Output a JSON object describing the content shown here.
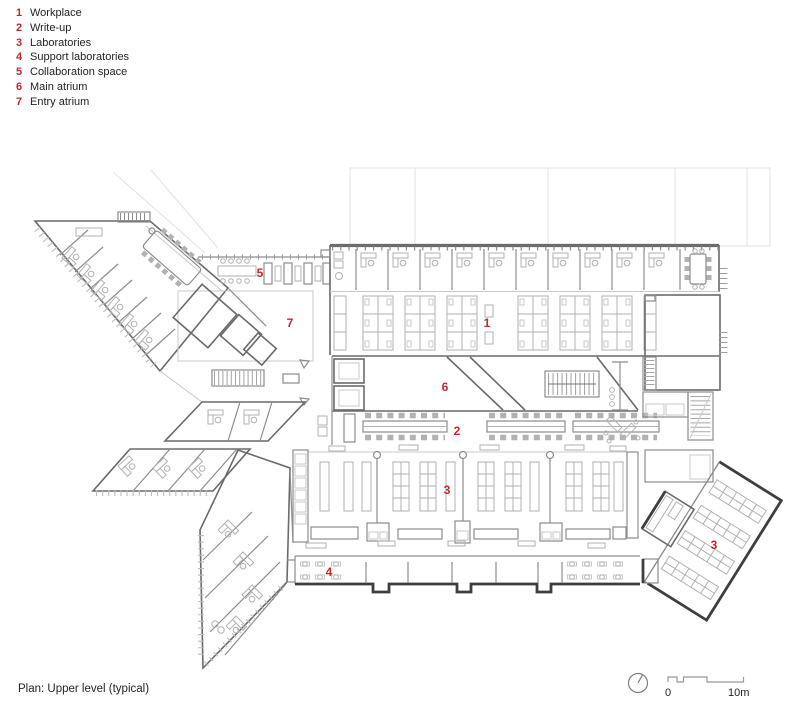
{
  "legend": {
    "items": [
      {
        "number": "1",
        "label": "Workplace"
      },
      {
        "number": "2",
        "label": "Write-up"
      },
      {
        "number": "3",
        "label": "Laboratories"
      },
      {
        "number": "4",
        "label": "Support laboratories"
      },
      {
        "number": "5",
        "label": "Collaboration space"
      },
      {
        "number": "6",
        "label": "Main atrium"
      },
      {
        "number": "7",
        "label": "Entry atrium"
      }
    ]
  },
  "caption": "Plan: Upper level (typical)",
  "plan": {
    "labels": [
      {
        "text": "1",
        "meaning": "Workplace"
      },
      {
        "text": "2",
        "meaning": "Write-up"
      },
      {
        "text": "3",
        "meaning": "Laboratories"
      },
      {
        "text": "4",
        "meaning": "Support laboratories"
      },
      {
        "text": "5",
        "meaning": "Collaboration space"
      },
      {
        "text": "6",
        "meaning": "Main atrium"
      },
      {
        "text": "7",
        "meaning": "Entry atrium"
      },
      {
        "text": "3",
        "meaning": "Laboratories (east wing)"
      }
    ]
  },
  "scale_bar": {
    "start_label": "0",
    "end_label": "10m"
  },
  "colors": {
    "label_red": "#c4272e",
    "wall_gray": "#6a6a6a",
    "heavy_wall": "#3e3e3e",
    "furniture_gray": "#b2b2b2",
    "context_gray": "#e2e2e2",
    "text": "#232323",
    "background": "#ffffff"
  }
}
